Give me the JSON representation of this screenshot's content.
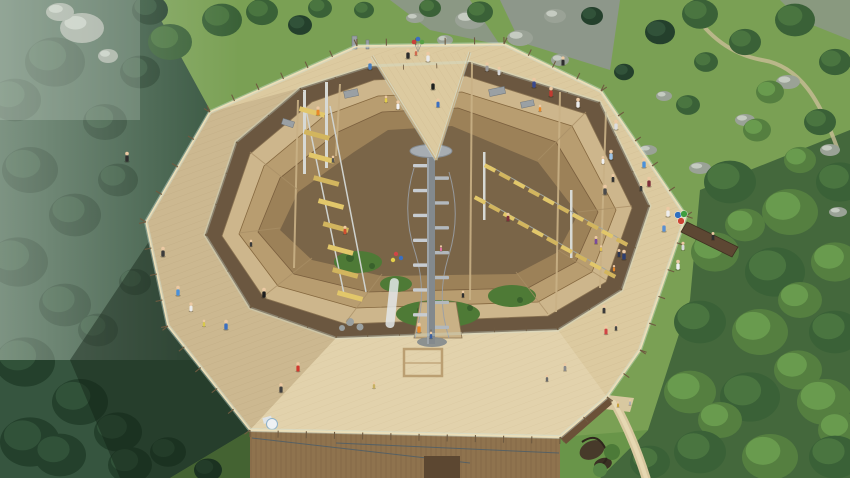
{
  "scene": {
    "description": "Aerial rendering of an octagonal wooden treetop observation tower with central spiral staircase, climbing courses, visitors on decks, surrounded by alpine forest, meadow, rocks and a waterfall"
  },
  "colors": {
    "meadow_base": "#7aa054",
    "rock_zone": "#8d978a",
    "rock": "#9aa296",
    "rock_light": "#cfd6cc",
    "forest_base_left": "#36553f",
    "forest_base_right": "#44683c",
    "grass_bottom": "#699549",
    "tree_dark_a": "#24402c",
    "tree_dark_b": "#315239",
    "tree_mid_a": "#3a6137",
    "tree_mid_b": "#4a7540",
    "tree_light_a": "#557f40",
    "tree_light_b": "#699b4e",
    "mist": "#dfe9df",
    "waterfall": "#e8efe9",
    "deck": "#dccaa0",
    "deck_fascia": "#ecdfb9",
    "plank_line": "#b99f74",
    "hole_base": "#6b5740",
    "ring1": "#cdb68c",
    "ring2": "#b89d70",
    "ring3": "#9c8158",
    "floor": "#7a6548",
    "inner_wood": "#c9b186",
    "beam": "#a98f66",
    "courtyard_green": "#4e7a36",
    "bush_green": "#39612c",
    "wall": "#8f734e",
    "wall_slat": "#6e5439",
    "door": "#5c4731",
    "cable": "#4e5e68",
    "course_frame": "#d7d9d4",
    "rung_a": "#e2c76a",
    "rung_b": "#d2b55e",
    "stair_column": "#83898d",
    "stair_step_a": "#c7ccd1",
    "stair_step_b": "#b2b8bd",
    "stair_platform": "#a7adb2",
    "railing_post": "#6e5a40",
    "glass": "#d2e4dc",
    "trail": "#d8c8a0",
    "skin": "#ecc9a3",
    "shadow": "rgba(16,32,20,0.42)"
  },
  "deck_outline": [
    [
      357,
      46
    ],
    [
      504,
      44
    ],
    [
      601,
      91
    ],
    [
      686,
      216
    ],
    [
      640,
      350
    ],
    [
      607,
      397
    ],
    [
      560,
      437
    ],
    [
      250,
      430
    ],
    [
      168,
      326
    ],
    [
      146,
      222
    ],
    [
      210,
      112
    ]
  ],
  "hole_outline": [
    [
      300,
      88
    ],
    [
      370,
      66
    ],
    [
      470,
      62
    ],
    [
      600,
      102
    ],
    [
      650,
      206
    ],
    [
      622,
      290
    ],
    [
      558,
      330
    ],
    [
      336,
      338
    ],
    [
      250,
      308
    ],
    [
      205,
      235
    ],
    [
      236,
      142
    ]
  ],
  "stair": {
    "cx": 431,
    "top": 164,
    "bottom": 338,
    "steps": 14
  },
  "railing": {
    "outer_spacing": 26,
    "outer_len": 7,
    "inner_spacing": 30,
    "inner_len": 5
  },
  "courses": [
    {
      "x1": 312,
      "y1": 112,
      "x2": 350,
      "y2": 296,
      "count": 9,
      "w": 26,
      "h": 5,
      "angle": 15
    },
    {
      "x1": 490,
      "y1": 168,
      "x2": 622,
      "y2": 242,
      "count": 10,
      "w": 12,
      "h": 4,
      "angle": 28
    },
    {
      "x1": 480,
      "y1": 200,
      "x2": 610,
      "y2": 274,
      "count": 10,
      "w": 12,
      "h": 4,
      "angle": 28
    }
  ],
  "balloons": {
    "x": 418,
    "y": 44,
    "colors": [
      "#c9403a",
      "#3b6fc0",
      "#58a044"
    ]
  },
  "parasol": {
    "x": 681,
    "y": 217,
    "colors": [
      "#2e6fbe",
      "#3f9e3f",
      "#cc4433"
    ]
  },
  "people": [
    [
      408,
      55,
      "#2b2b2b",
      1
    ],
    [
      428,
      58,
      "#e9e9e9",
      1
    ],
    [
      370,
      66,
      "#4a7fc1",
      1
    ],
    [
      386,
      100,
      "#e3cf49",
      0.7
    ],
    [
      398,
      106,
      "#f2f2f2",
      0.9
    ],
    [
      433,
      86,
      "#1f1f1f",
      1
    ],
    [
      438,
      104,
      "#3b6fc0",
      0.9
    ],
    [
      416,
      53,
      "#cf6a4f",
      0.7
    ],
    [
      487,
      68,
      "#9a9a9a",
      0.9
    ],
    [
      499,
      72,
      "#d8d8d8",
      0.85
    ],
    [
      534,
      84,
      "#39498e",
      1
    ],
    [
      551,
      93,
      "#c23a30",
      1
    ],
    [
      540,
      109,
      "#e8882a",
      0.7
    ],
    [
      563,
      62,
      "#2e2e2e",
      0.9
    ],
    [
      578,
      104,
      "#ececec",
      1
    ],
    [
      616,
      126,
      "#dddddd",
      1
    ],
    [
      611,
      156,
      "#9ec4e8",
      1
    ],
    [
      644,
      164,
      "#4a90d9",
      1
    ],
    [
      649,
      183,
      "#7e2f3a",
      1
    ],
    [
      641,
      188,
      "#3a3a3a",
      0.8
    ],
    [
      605,
      191,
      "#4a4a4a",
      1
    ],
    [
      668,
      213,
      "#ededed",
      1
    ],
    [
      664,
      228,
      "#5a8fd0",
      1
    ],
    [
      683,
      247,
      "#d8d8d8",
      0.85
    ],
    [
      678,
      266,
      "#f0f0f0",
      1
    ],
    [
      624,
      256,
      "#2c3e70",
      1
    ],
    [
      614,
      269,
      "#e8882a",
      0.65
    ],
    [
      604,
      310,
      "#3a3a3a",
      0.85
    ],
    [
      606,
      331,
      "#d04545",
      0.9
    ],
    [
      616,
      328,
      "#474747",
      0.7
    ],
    [
      713,
      237,
      "#2e2e2e",
      0.8
    ],
    [
      603,
      161,
      "#f0f0f0",
      0.8
    ],
    [
      613,
      179,
      "#333333",
      0.8
    ],
    [
      596,
      241,
      "#7a4a9a",
      0.8
    ],
    [
      601,
      249,
      "#e0c050",
      0.6
    ],
    [
      619,
      254,
      "#2c3550",
      0.8
    ],
    [
      127,
      158,
      "#2f2f2f",
      1
    ],
    [
      163,
      253,
      "#3b3b3b",
      1
    ],
    [
      178,
      292,
      "#4a90d9",
      1
    ],
    [
      191,
      308,
      "#ececec",
      0.9
    ],
    [
      204,
      324,
      "#d8c84a",
      0.7
    ],
    [
      226,
      326,
      "#3b6fc0",
      1
    ],
    [
      264,
      294,
      "#1d1d1d",
      1
    ],
    [
      298,
      368,
      "#d0392e",
      0.95
    ],
    [
      281,
      389,
      "#3f3f3f",
      0.95
    ],
    [
      374,
      386,
      "#c8b060",
      0.7
    ],
    [
      419,
      329,
      "#e8882a",
      1
    ],
    [
      431,
      336,
      "#3a5fa0",
      0.7
    ],
    [
      565,
      368,
      "#8a8a8a",
      0.8
    ],
    [
      547,
      379,
      "#6a6a6a",
      0.7
    ],
    [
      345,
      231,
      "#d05030",
      0.85
    ],
    [
      318,
      112,
      "#e8882a",
      0.9
    ],
    [
      441,
      249,
      "#e070a0",
      0.6
    ],
    [
      508,
      218,
      "#7e2f3a",
      0.85
    ],
    [
      251,
      244,
      "#3a3a3a",
      0.7
    ],
    [
      463,
      295,
      "#2e2e2e",
      0.7
    ],
    [
      333,
      160,
      "#555555",
      0.7
    ],
    [
      618,
      405,
      "#c9a23f",
      0.6
    ],
    [
      630,
      403,
      "#b0b0b0",
      0.6
    ]
  ],
  "trees": [
    [
      150,
      10,
      18,
      "dark"
    ],
    [
      170,
      42,
      22,
      "mid"
    ],
    [
      222,
      20,
      20,
      "mid"
    ],
    [
      262,
      12,
      16,
      "mid"
    ],
    [
      300,
      25,
      12,
      "dark"
    ],
    [
      320,
      8,
      12,
      "mid"
    ],
    [
      364,
      10,
      10,
      "mid"
    ],
    [
      430,
      8,
      11,
      "mid"
    ],
    [
      480,
      12,
      13,
      "mid"
    ],
    [
      592,
      16,
      11,
      "dark"
    ],
    [
      660,
      32,
      15,
      "dark"
    ],
    [
      624,
      72,
      10,
      "dark"
    ],
    [
      700,
      14,
      18,
      "mid"
    ],
    [
      745,
      42,
      16,
      "mid"
    ],
    [
      795,
      20,
      20,
      "mid"
    ],
    [
      835,
      62,
      16,
      "mid"
    ],
    [
      706,
      62,
      12,
      "mid"
    ],
    [
      688,
      105,
      12,
      "mid"
    ],
    [
      770,
      92,
      14,
      "light"
    ],
    [
      757,
      130,
      14,
      "light"
    ],
    [
      800,
      160,
      16,
      "light"
    ],
    [
      820,
      122,
      16,
      "mid"
    ],
    [
      55,
      62,
      30,
      "dark"
    ],
    [
      15,
      100,
      26,
      "dark"
    ],
    [
      105,
      122,
      22,
      "dark"
    ],
    [
      140,
      72,
      20,
      "dark"
    ],
    [
      30,
      170,
      28,
      "dark"
    ],
    [
      118,
      180,
      20,
      "dark"
    ],
    [
      75,
      215,
      26,
      "dark"
    ],
    [
      18,
      262,
      30,
      "dark"
    ],
    [
      135,
      282,
      16,
      "dark"
    ],
    [
      65,
      305,
      26,
      "dark"
    ],
    [
      98,
      330,
      20,
      "dark"
    ],
    [
      25,
      362,
      30,
      "dark"
    ],
    [
      80,
      402,
      28,
      "dark"
    ],
    [
      30,
      442,
      30,
      "dark"
    ],
    [
      118,
      432,
      24,
      "dark"
    ],
    [
      60,
      455,
      26,
      "dark"
    ],
    [
      130,
      465,
      22,
      "dark"
    ],
    [
      168,
      452,
      18,
      "dark"
    ],
    [
      208,
      470,
      14,
      "dark"
    ],
    [
      730,
      182,
      26,
      "mid"
    ],
    [
      840,
      182,
      24,
      "mid"
    ],
    [
      790,
      212,
      28,
      "light"
    ],
    [
      745,
      225,
      20,
      "light"
    ],
    [
      715,
      252,
      24,
      "light"
    ],
    [
      775,
      272,
      30,
      "mid"
    ],
    [
      835,
      262,
      24,
      "light"
    ],
    [
      800,
      300,
      22,
      "light"
    ],
    [
      700,
      322,
      26,
      "mid"
    ],
    [
      760,
      332,
      28,
      "light"
    ],
    [
      835,
      332,
      26,
      "mid"
    ],
    [
      798,
      370,
      24,
      "light"
    ],
    [
      690,
      392,
      26,
      "light"
    ],
    [
      750,
      397,
      30,
      "mid"
    ],
    [
      825,
      402,
      28,
      "light"
    ],
    [
      720,
      420,
      22,
      "light"
    ],
    [
      840,
      430,
      22,
      "light"
    ],
    [
      700,
      452,
      26,
      "mid"
    ],
    [
      770,
      457,
      28,
      "light"
    ],
    [
      835,
      457,
      26,
      "mid"
    ],
    [
      650,
      462,
      20,
      "mid"
    ]
  ],
  "rocks": [
    [
      82,
      28,
      22,
      15
    ],
    [
      108,
      56,
      10,
      7
    ],
    [
      60,
      12,
      14,
      9
    ],
    [
      470,
      20,
      15,
      9
    ],
    [
      520,
      38,
      13,
      8
    ],
    [
      555,
      16,
      11,
      7
    ],
    [
      560,
      60,
      9,
      6
    ],
    [
      445,
      40,
      8,
      5
    ],
    [
      415,
      18,
      9,
      5
    ],
    [
      364,
      12,
      8,
      5
    ],
    [
      610,
      120,
      10,
      6
    ],
    [
      648,
      150,
      9,
      5
    ],
    [
      700,
      168,
      11,
      6
    ],
    [
      745,
      120,
      10,
      6
    ],
    [
      788,
      82,
      12,
      7
    ],
    [
      830,
      150,
      10,
      6
    ],
    [
      664,
      96,
      8,
      5
    ],
    [
      596,
      176,
      8,
      5
    ],
    [
      838,
      212,
      9,
      5
    ]
  ]
}
